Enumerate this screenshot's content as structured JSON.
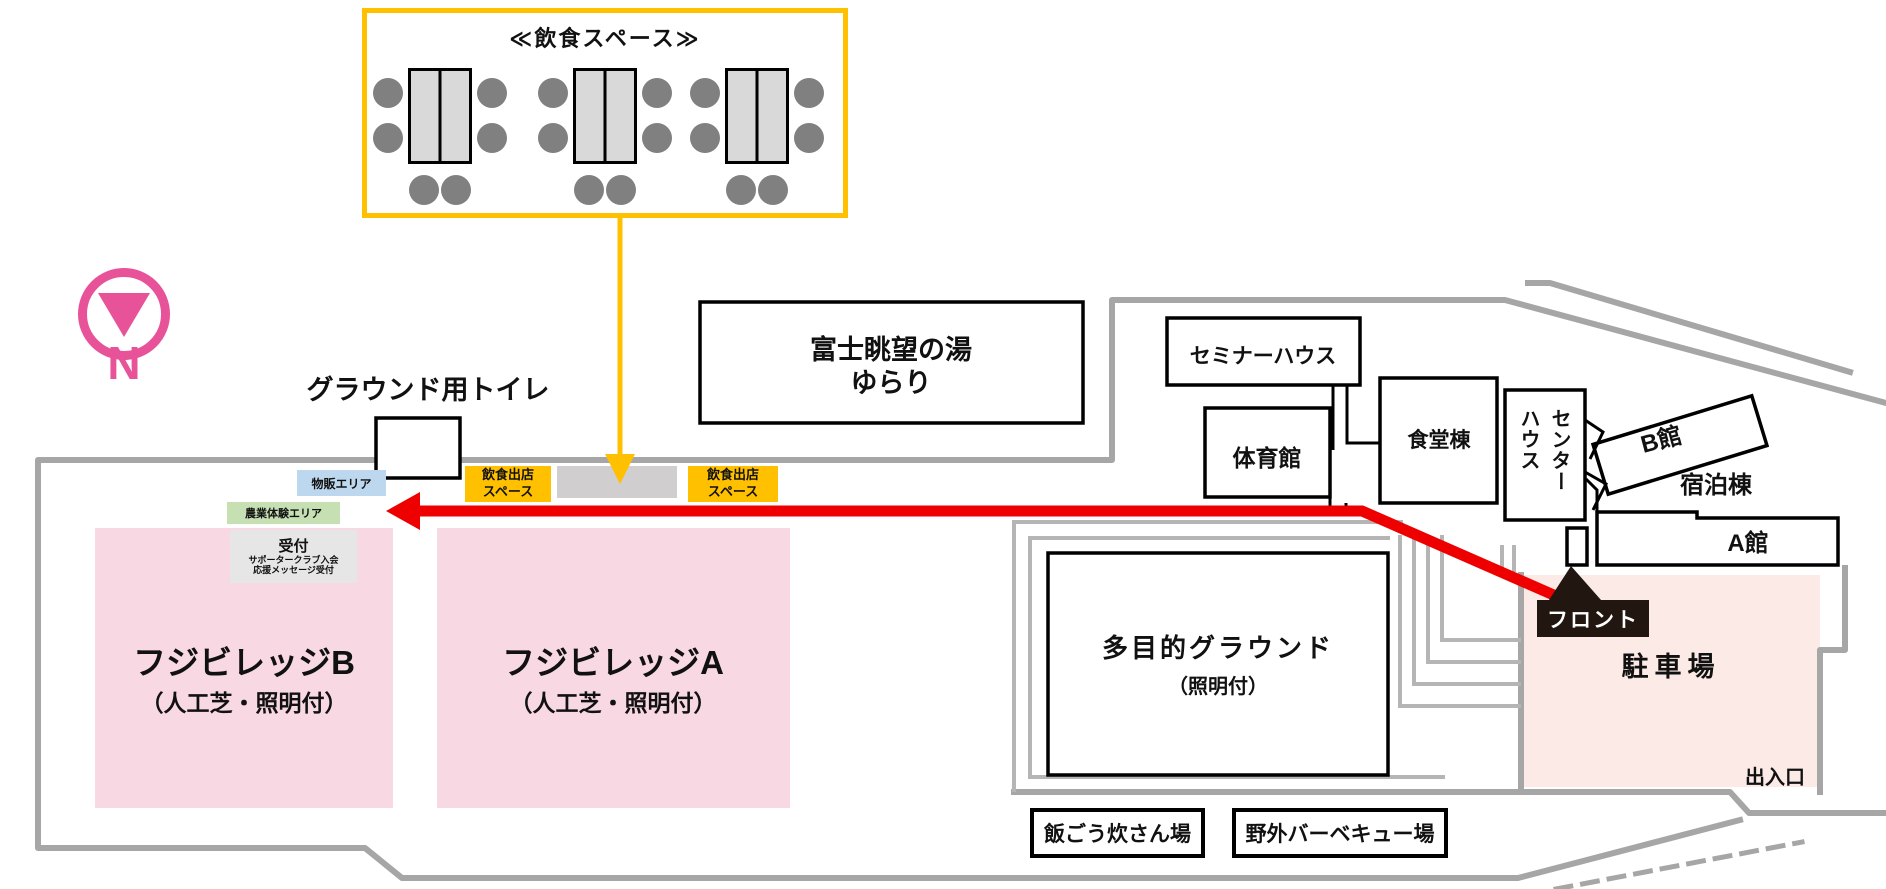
{
  "dining_detail": {
    "title": "≪飲食スペース≫",
    "table_count": 3,
    "seats_per_table": 6
  },
  "compass": {
    "label": "N"
  },
  "labels": {
    "ground_toilet": "グラウンド用トイレ",
    "entrance": "出入口",
    "front": "フロント"
  },
  "buildings": {
    "yurari_line1": "富士眺望の湯",
    "yurari_line2": "ゆらり",
    "seminar_house": "セミナーハウス",
    "gym": "体育館",
    "dining_building": "食堂棟",
    "center_house": {
      "line1": "センター",
      "line2": "ハウス"
    },
    "building_b": "B館",
    "lodging": "宿泊棟",
    "building_a": "A館",
    "multi_ground_line1": "多目的グラウンド",
    "multi_ground_line2": "（照明付）",
    "rice_cooking": "飯ごう炊さん場",
    "bbq": "野外バーベキュー場"
  },
  "areas": {
    "merch": "物販エリア",
    "farm": "農業体験エリア",
    "reception": {
      "title": "受付",
      "line1": "サポータークラブ入会",
      "line2": "応援メッセージ受付"
    },
    "food_stall": "飲食出店スペース",
    "village_b": "フジビレッジB",
    "village_a": "フジビレッジA",
    "turf_note": "（人工芝・照明付）",
    "parking": "駐車場"
  },
  "colors": {
    "accent": "#FFC000",
    "seat": "#808080",
    "tablefill": "#d9d9d9",
    "dspace": "#d0cece",
    "field": "#f8d8e3",
    "parking": "#fbeae6",
    "merch": "#bdd7ee",
    "farm": "#c6e0b4",
    "recept": "#e7e6e6",
    "compass": "#e85298",
    "red": "#ee0000",
    "frontdark": "#221611",
    "outline": "#a6a6a6",
    "path": "#b5b5b5"
  }
}
